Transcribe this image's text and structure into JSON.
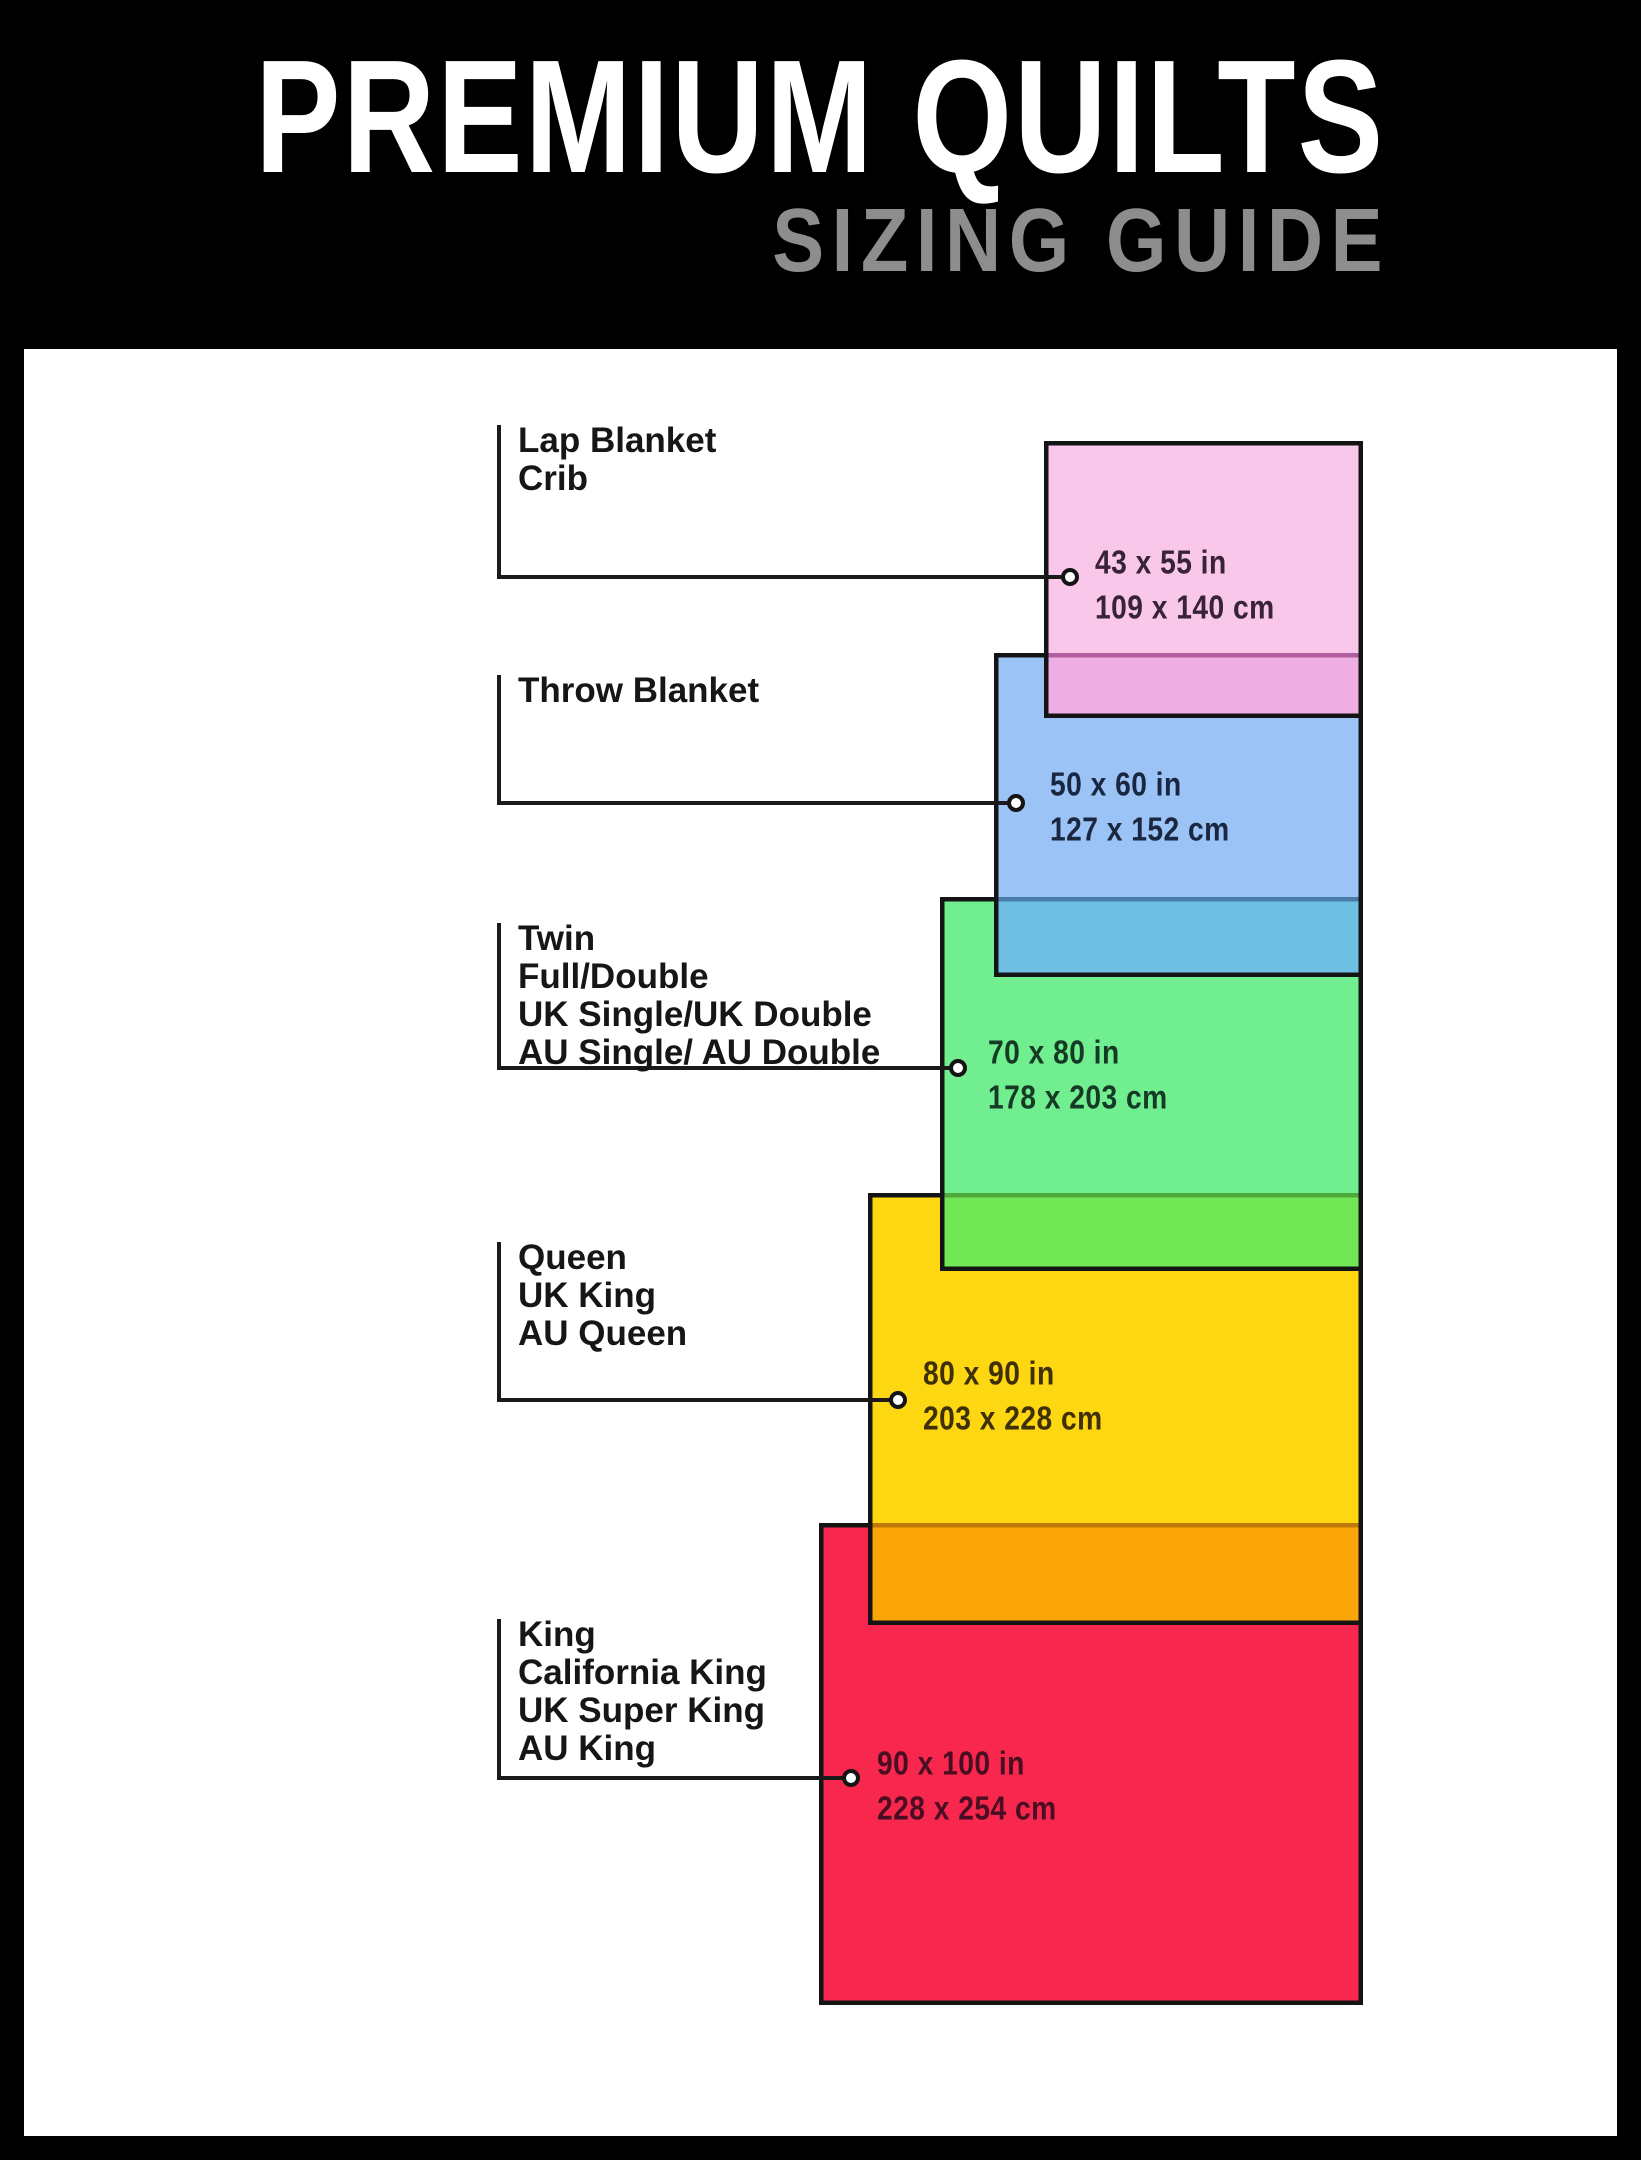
{
  "header": {
    "title": "PREMIUM QUILTS",
    "subtitle": "SIZING GUIDE",
    "bg_color": "#000000",
    "title_color": "#FFFFFF",
    "subtitle_color": "#8D8D8D"
  },
  "canvas": {
    "content_bg": "#FFFFFF",
    "line_color": "#1A1A1A",
    "label_color": "#161616",
    "border_color": "#141414"
  },
  "sizes": [
    {
      "id": "lap",
      "names": [
        "Lap Blanket",
        "Crib"
      ],
      "inches": "43 x 55 in",
      "cm": "109 x 140 cm",
      "fill": "#F9C7E9",
      "dims_color": "#392339"
    },
    {
      "id": "throw",
      "names": [
        "Throw Blanket"
      ],
      "inches": "50 x 60 in",
      "cm": "127 x 152 cm",
      "fill": "#9CC3F5",
      "dims_color": "#1A2740"
    },
    {
      "id": "twin",
      "names": [
        "Twin",
        "Full/Double",
        "UK Single/UK Double",
        "AU Single/ AU Double"
      ],
      "inches": "70 x 80 in",
      "cm": "178 x 203 cm",
      "fill": "#71EE8F",
      "dims_color": "#153A26"
    },
    {
      "id": "queen",
      "names": [
        "Queen",
        "UK King",
        "AU Queen"
      ],
      "inches": "80 x 90 in",
      "cm": "203 x 228 cm",
      "fill": "#FDD712",
      "dims_color": "#3F3007"
    },
    {
      "id": "king",
      "names": [
        "King",
        "California King",
        "UK Super King",
        "AU King"
      ],
      "inches": "90 x 100 in",
      "cm": "228 x 254 cm",
      "fill": "#F8274E",
      "dims_color": "#4A0E22"
    }
  ],
  "overlaps": [
    {
      "between": [
        "lap",
        "throw"
      ],
      "color": "#EFAEE4",
      "seam_color": "#B05E9E"
    },
    {
      "between": [
        "throw",
        "twin"
      ],
      "color": "#6FC1E4",
      "seam_color": "#4A7CAC"
    },
    {
      "between": [
        "twin",
        "queen"
      ],
      "color": "#72E755",
      "seam_color": "#4FA93A"
    },
    {
      "between": [
        "queen",
        "king"
      ],
      "color": "#FAA508",
      "seam_color": "#C07907"
    }
  ]
}
